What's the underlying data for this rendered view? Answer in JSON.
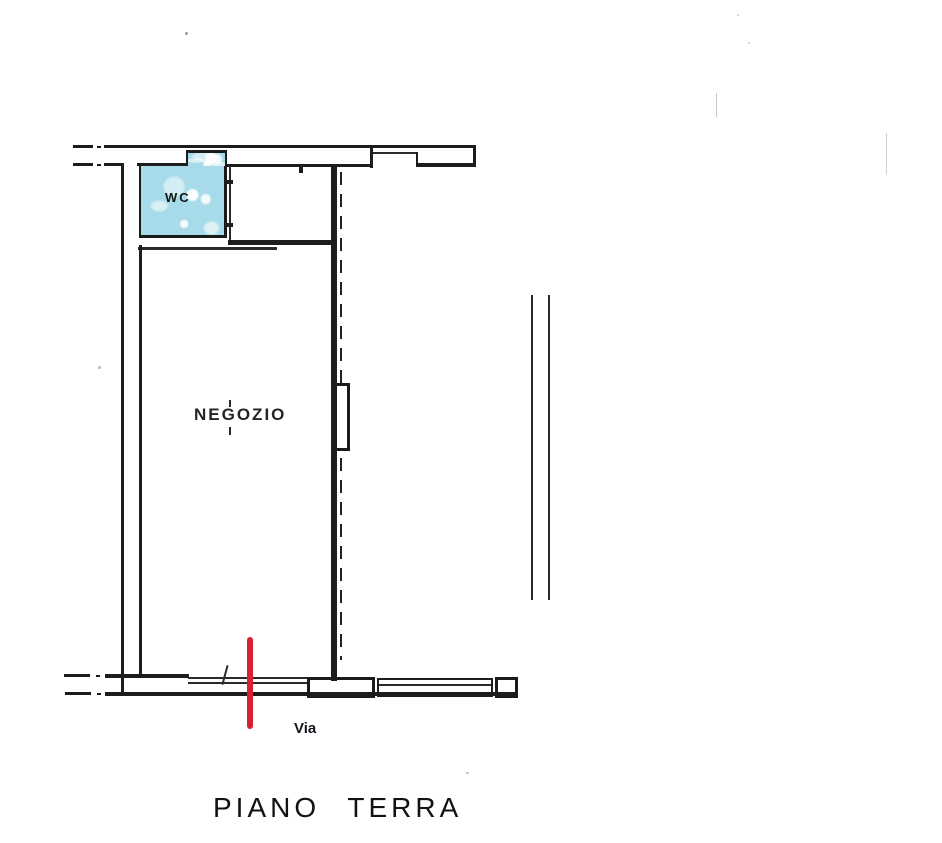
{
  "floor_plan": {
    "title": "PIANO TERRA",
    "street_label": "Via",
    "rooms": [
      {
        "name": "wc",
        "label": "WC",
        "fill": "#a7dbe9"
      },
      {
        "name": "shop",
        "label": "NEGOZIO",
        "fill": "#ffffff"
      }
    ],
    "colors": {
      "wall_line": "#1d1d1d",
      "wc_fill": "#a7dbe9",
      "entrance_marker": "#d6222d",
      "paper": "#ffffff"
    },
    "symbols": [
      "wall-break-dash-dot",
      "dashed-projection-line",
      "column-block",
      "window-double-line",
      "entrance-red-line"
    ]
  }
}
